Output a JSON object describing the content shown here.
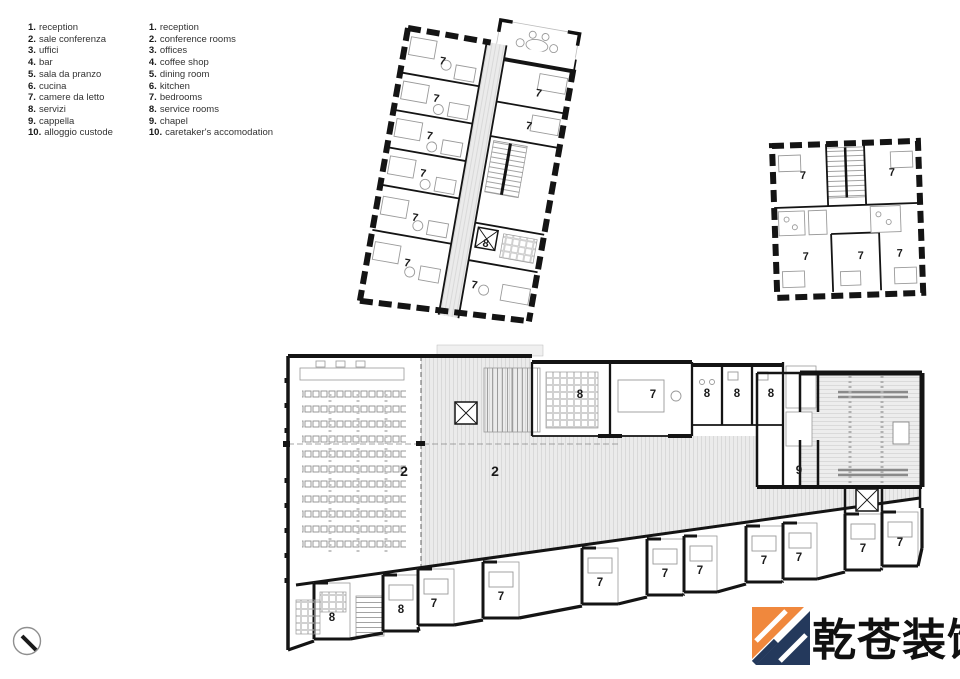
{
  "legend": {
    "italian": {
      "items": [
        {
          "num": "1.",
          "label": "reception"
        },
        {
          "num": "2.",
          "label": "sale conferenza"
        },
        {
          "num": "3.",
          "label": "uffici"
        },
        {
          "num": "4.",
          "label": "bar"
        },
        {
          "num": "5.",
          "label": "sala da pranzo"
        },
        {
          "num": "6.",
          "label": "cucina"
        },
        {
          "num": "7.",
          "label": "camere da letto"
        },
        {
          "num": "8.",
          "label": "servizi"
        },
        {
          "num": "9.",
          "label": "cappella"
        },
        {
          "num": "10.",
          "label": "alloggio custode"
        }
      ]
    },
    "english": {
      "items": [
        {
          "num": "1.",
          "label": "reception"
        },
        {
          "num": "2.",
          "label": "conference rooms"
        },
        {
          "num": "3.",
          "label": "offices"
        },
        {
          "num": "4.",
          "label": "coffee shop"
        },
        {
          "num": "5.",
          "label": "dining room"
        },
        {
          "num": "6.",
          "label": "kitchen"
        },
        {
          "num": "7.",
          "label": "bedrooms"
        },
        {
          "num": "8.",
          "label": "service rooms"
        },
        {
          "num": "9.",
          "label": "chapel"
        },
        {
          "num": "10.",
          "label": "caretaker's accomodation"
        }
      ]
    }
  },
  "plans": {
    "bedroom_wing": {
      "labels": [
        "7",
        "7",
        "7",
        "7",
        "7",
        "7",
        "7",
        "7",
        "8",
        "7"
      ]
    },
    "small_block": {
      "labels": [
        "7",
        "7",
        "7",
        "7",
        "7"
      ]
    },
    "ground_floor": {
      "labels": [
        "2",
        "2",
        "8",
        "7",
        "8",
        "8",
        "8",
        "9",
        "8",
        "8",
        "7",
        "7",
        "7",
        "7",
        "7",
        "7",
        "7",
        "7",
        "7"
      ]
    }
  },
  "watermark": {
    "text": "乾苍装饰",
    "colors": {
      "orange": "#f0883d",
      "navy": "#24395c",
      "ink": "#101010"
    }
  },
  "wall_color": "#141414"
}
